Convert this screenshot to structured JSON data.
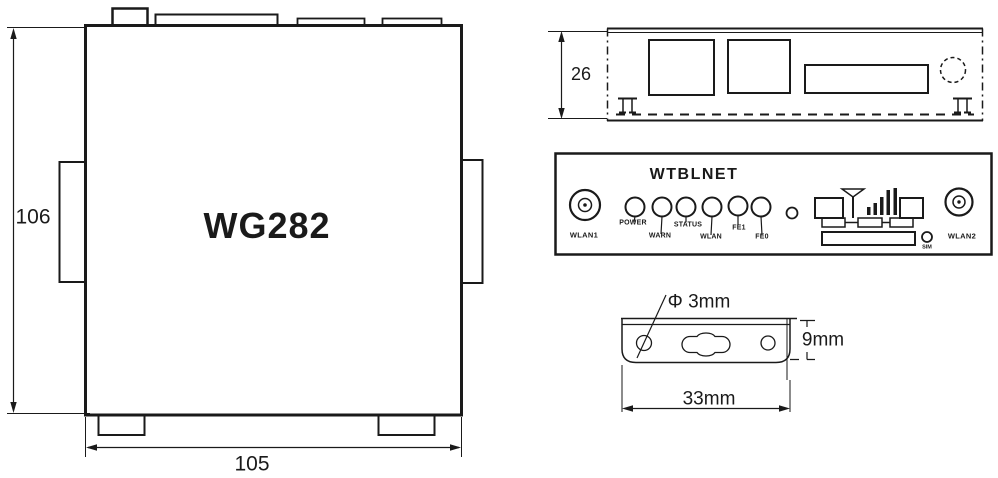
{
  "colors": {
    "ink": "#1a1a1a",
    "background": "#ffffff"
  },
  "top_view": {
    "model": "WG282",
    "height_mm": "106",
    "width_mm": "105"
  },
  "rear_view": {
    "height_mm": "26"
  },
  "front_panel": {
    "brand": "WTBLNET",
    "antenna_left": "WLAN1",
    "antenna_right": "WLAN2",
    "leds": [
      "POWER",
      "WARN",
      "STATUS",
      "WLAN",
      "FE1",
      "FE0"
    ],
    "sim": "SIM"
  },
  "bracket": {
    "hole_diameter": "Φ 3mm",
    "height": "9mm",
    "width": "33mm"
  }
}
